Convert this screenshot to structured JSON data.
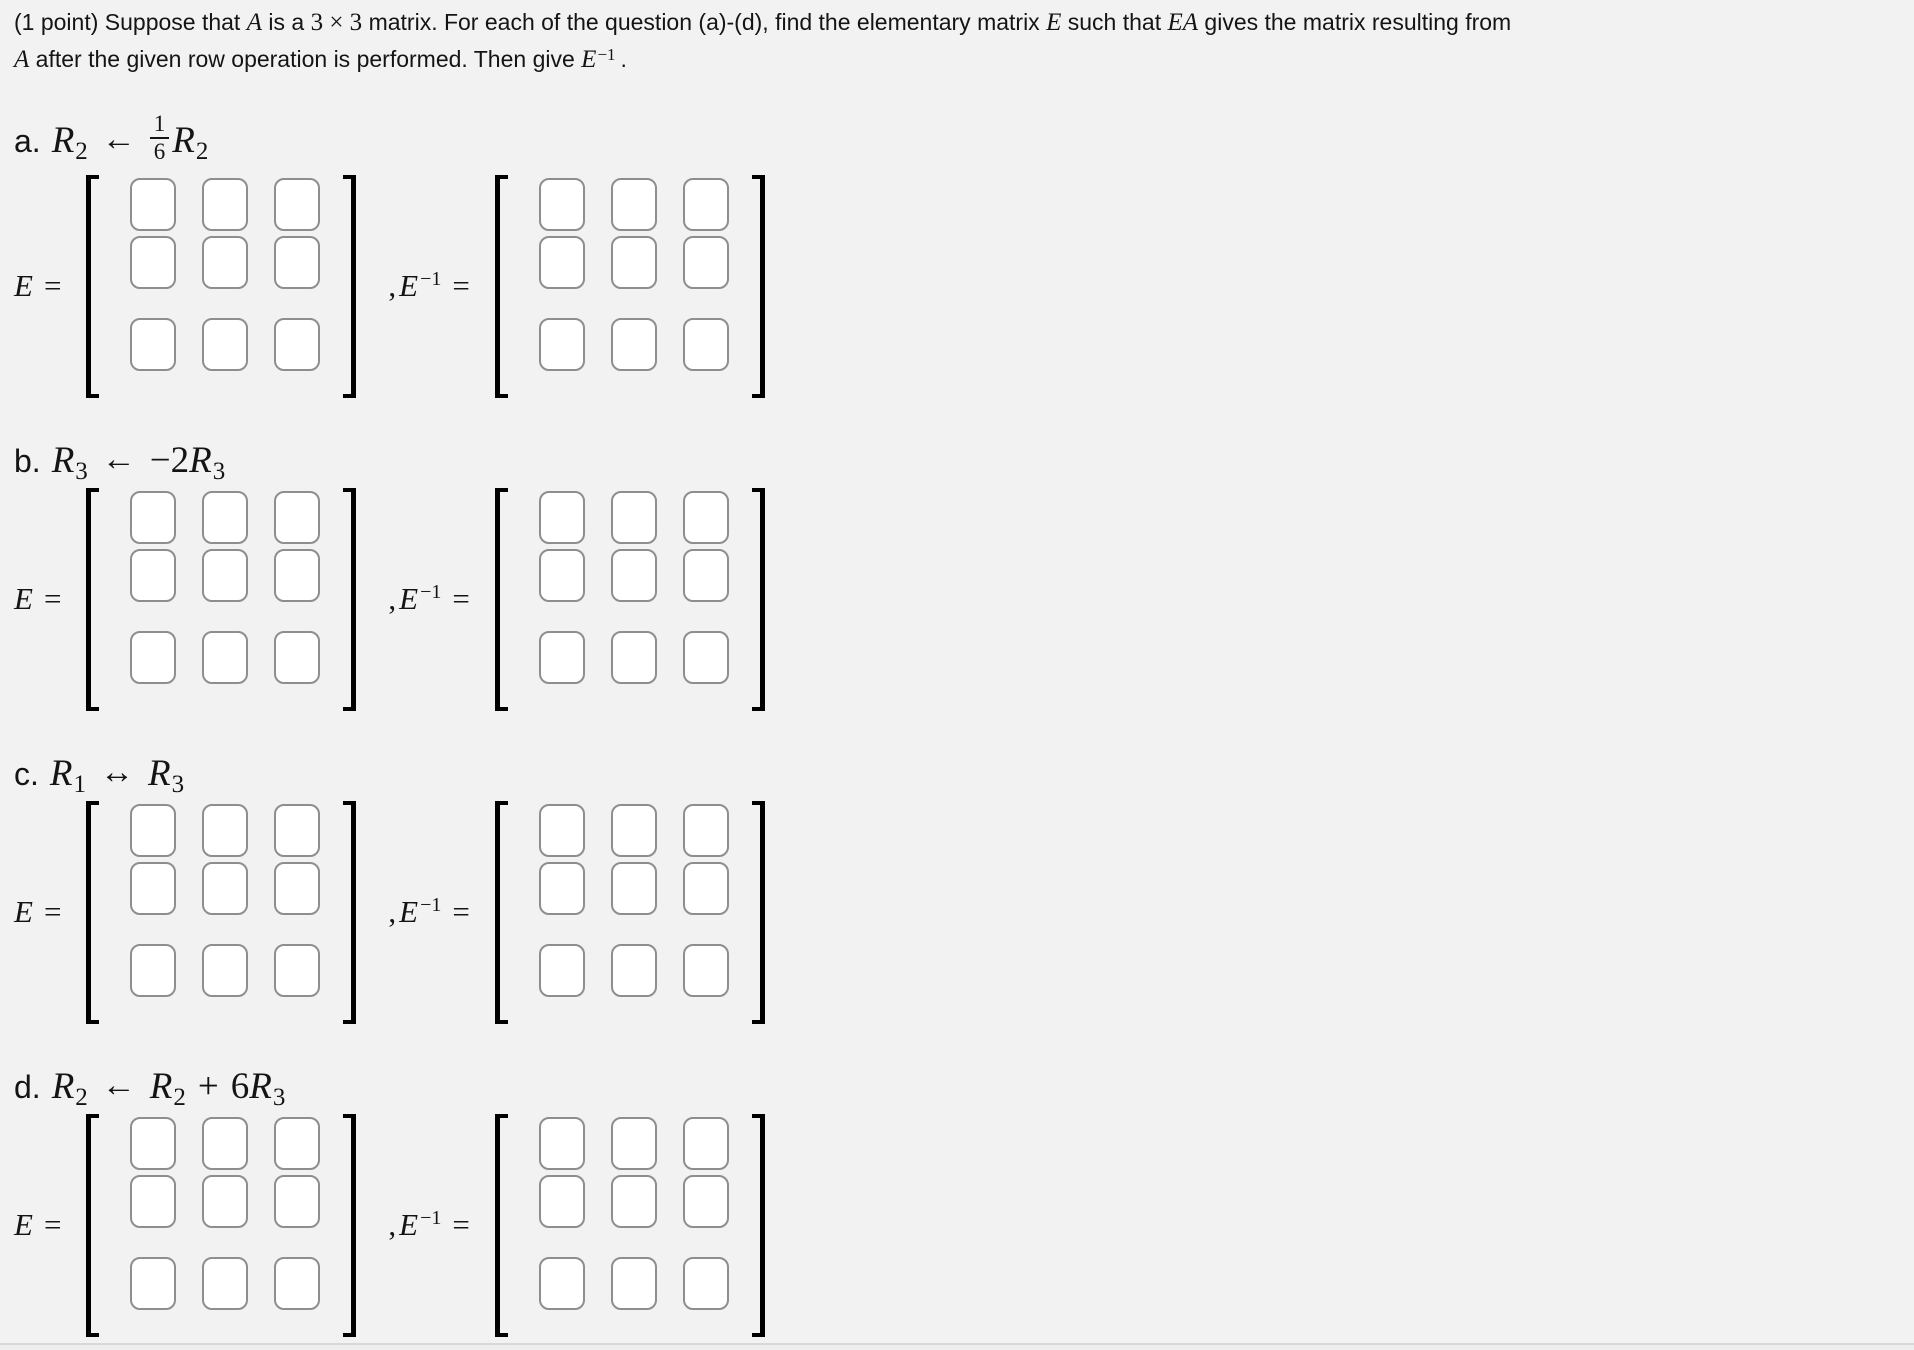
{
  "page": {
    "background": "#f2f2f2",
    "text_color": "#141414",
    "box_border_color": "#8e8e8e",
    "bracket_color": "#000000",
    "bottom_bar_color": "#ededed"
  },
  "header": {
    "segments": [
      "(1 point) Suppose that ",
      "A",
      " is a ",
      "3 × 3",
      " matrix. For each of the question (a)-(d), find the elementary matrix ",
      "E",
      " such that ",
      "EA",
      " gives the matrix resulting from",
      "A",
      " after the given row operation is performed. Then give ",
      "E",
      "−1",
      "."
    ]
  },
  "math": {
    "E": "E",
    "eq": "=",
    "comma": ",",
    "inv_sup": "−1"
  },
  "parts": [
    {
      "letter": "a.",
      "op": {
        "lhs": "R",
        "lhs_sub": "2",
        "arrow": "←",
        "frac_num": "1",
        "frac_den": "6",
        "rhs": "R",
        "rhs_sub": "2"
      }
    },
    {
      "letter": "b.",
      "op": {
        "lhs": "R",
        "lhs_sub": "3",
        "arrow": "←",
        "coef": "−2",
        "rhs": "R",
        "rhs_sub": "3"
      }
    },
    {
      "letter": "c.",
      "op": {
        "lhs": "R",
        "lhs_sub": "1",
        "arrow": "↔",
        "rhs": "R",
        "rhs_sub": "3"
      }
    },
    {
      "letter": "d.",
      "op": {
        "lhs": "R",
        "lhs_sub": "2",
        "arrow": "←",
        "rhs": "R",
        "rhs_sub": "2",
        "plus": "+",
        "coef2": "6",
        "rhs2": "R",
        "rhs2_sub": "3"
      }
    }
  ],
  "matrix": {
    "rows": 3,
    "cols": 3,
    "cell_value": ""
  }
}
